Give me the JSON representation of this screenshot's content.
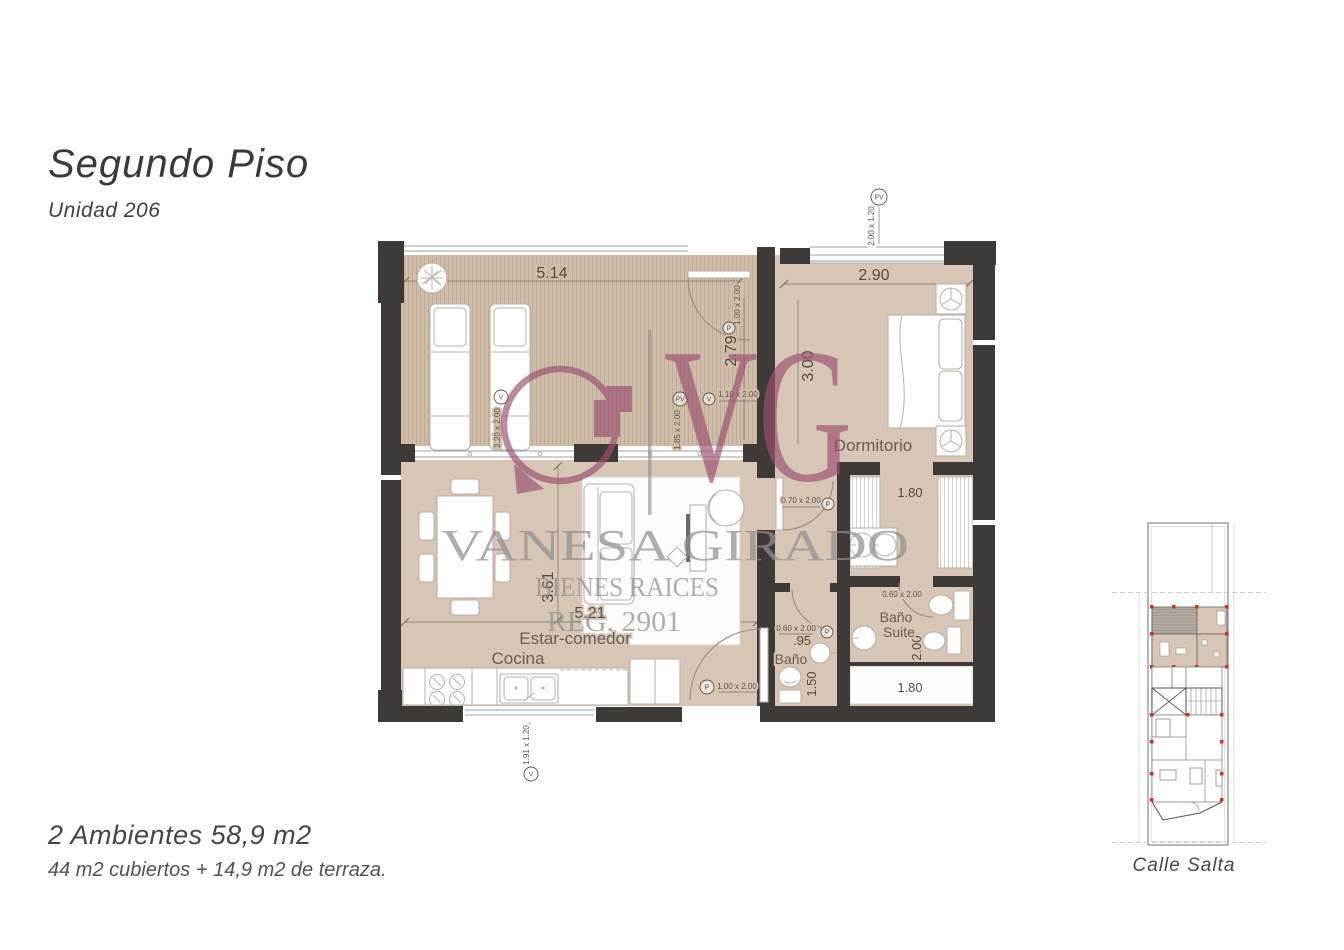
{
  "header": {
    "title": "Segundo Piso",
    "subtitle": "Unidad 206"
  },
  "summary": {
    "line1": "2 Ambientes 58,9 m2",
    "line2": "44 m2 cubiertos + 14,9 m2 de terraza."
  },
  "watermark": {
    "monogram": "VG",
    "name": "VANESA GIRADO",
    "tagline": "BIENES RAICES",
    "registry": "REG. 2901"
  },
  "floorplan": {
    "rooms": {
      "bedroom": "Dormitorio",
      "living": "Estar-comedor",
      "kitchen": "Cocina",
      "bath": "Baño",
      "suite_line1": "Baño",
      "suite_line2": "Suite"
    },
    "dims": {
      "terrace_width": "5.14",
      "terrace_depth": "2.79",
      "bedroom_width": "2.90",
      "bedroom_depth": "3.00",
      "living_width": "5.21",
      "living_depth": "3.61",
      "dressing_width": "1.80",
      "suite_depth": "2.00",
      "ledge_width": "1.80",
      "bath_width": ".95",
      "bath_depth": "1.50"
    },
    "openings": {
      "terrace_door": {
        "tag": "P",
        "size": "1.00 x 2.00"
      },
      "bedroom_window": {
        "tag": "PV",
        "size": "2.00 x 1.20"
      },
      "terrace_window": {
        "tag": "V",
        "size": "2.20 x 2.00"
      },
      "hall_pv": {
        "tag": "PV"
      },
      "hall_window": {
        "tag": "V",
        "size": "1.10 x 2.00"
      },
      "terrace_slider": {
        "size": "1.85 x 2.00"
      },
      "corridor_door": {
        "tag": "P",
        "size": "0.70 x 2.00"
      },
      "suite_door": {
        "size": "0.60 x 2.00"
      },
      "bath_door": {
        "tag": "P",
        "size": "0.60 x 2.00"
      },
      "entry_door": {
        "tag": "P",
        "size": "1.00 x 2.00"
      },
      "kitchen_window": {
        "tag": "V",
        "size": "1.91 x 1.20"
      }
    }
  },
  "siteplan": {
    "street": "Calle Salta"
  },
  "colors": {
    "wall": "#3e3a37",
    "floor": "#d7c5b5",
    "deck": "#cfbca9",
    "brand_plum": "#9c5173",
    "watermark_gray": "#8f8f8f",
    "marker_red": "#cc3326"
  }
}
